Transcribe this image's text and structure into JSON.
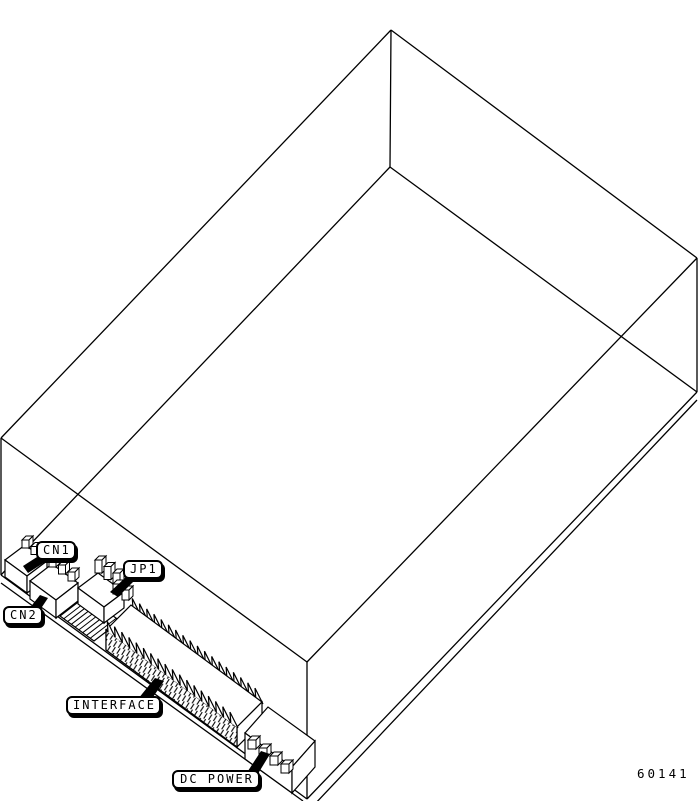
{
  "diagram": {
    "description": "isometric line drawing of a disk drive, bottom-front view, with connector callouts",
    "colors": {
      "line": "#000000",
      "background": "#ffffff"
    }
  },
  "callouts": {
    "cn1": "CN1",
    "cn2": "CN2",
    "jp1": "JP1",
    "interface": "INTERFACE",
    "dc_power": "DC POWER"
  },
  "figure_number": "60141"
}
